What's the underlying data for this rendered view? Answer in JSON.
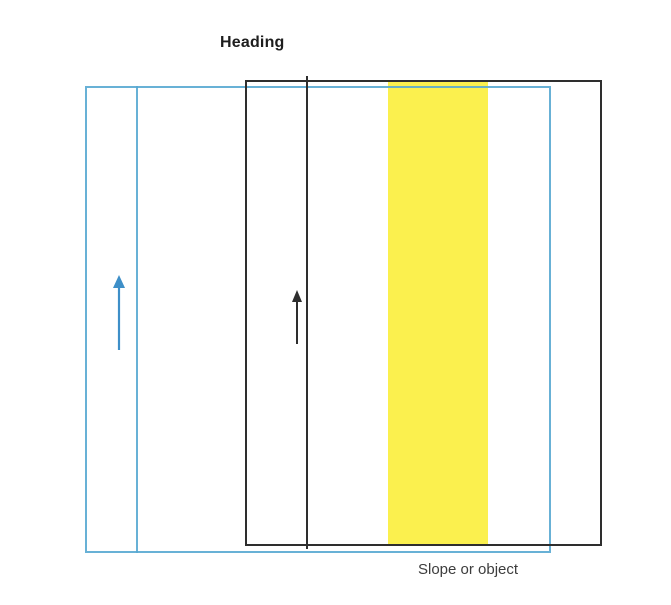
{
  "title": {
    "text": "Heading"
  },
  "caption": {
    "text": "Slope or object"
  },
  "colors": {
    "blue-line": "#58A9D2",
    "blue-arrow": "#3E8FC8",
    "black-line": "#2E2E2E",
    "yellow": "#FBF04E",
    "heading-text": "#1E1E1E",
    "caption-text": "#3D3D3D",
    "background": "#FFFFFF"
  },
  "icons": {
    "blue_arrow": "up-arrow",
    "black_arrow": "up-arrow"
  }
}
